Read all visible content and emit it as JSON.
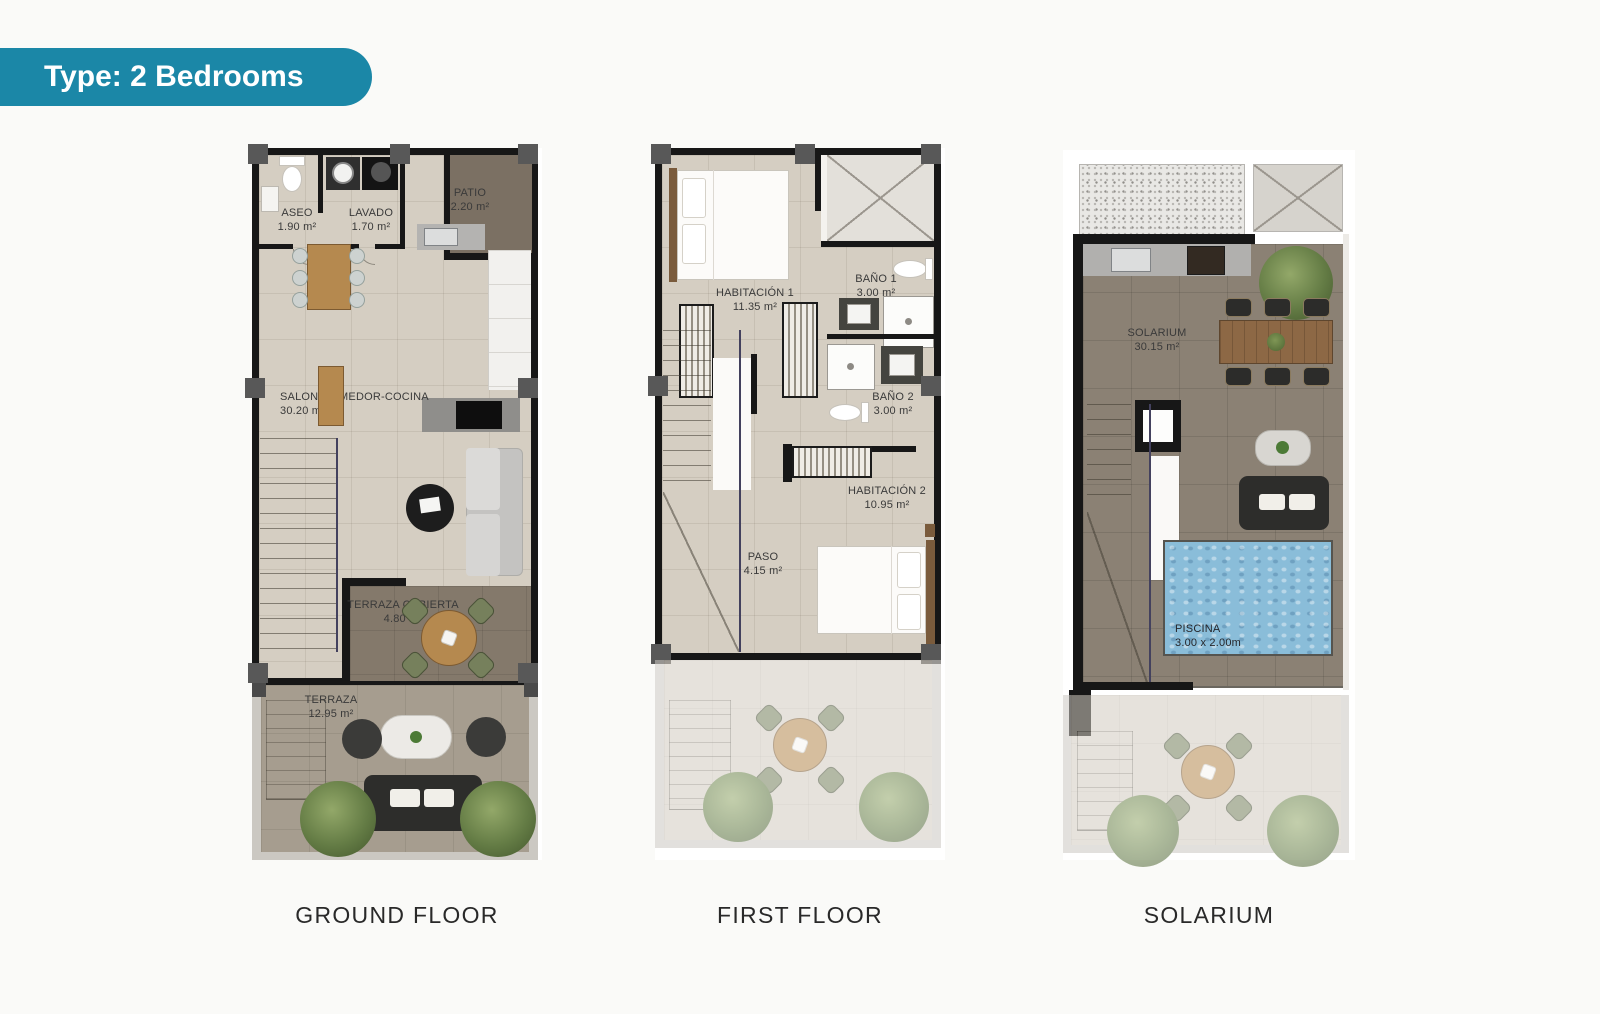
{
  "badge": {
    "label": "Type: 2 Bedrooms"
  },
  "floors": [
    {
      "caption": "GROUND FLOOR",
      "rooms": {
        "aseo": {
          "name": "ASEO",
          "area": "1.90 m²"
        },
        "lavado": {
          "name": "LAVADO",
          "area": "1.70 m²"
        },
        "patio": {
          "name": "PATIO",
          "area": "2.20 m²"
        },
        "salon": {
          "name": "SALON-COMEDOR-COCINA",
          "area": "30.20 m²"
        },
        "terraza_cubierta": {
          "name": "TERRAZA CUBIERTA",
          "area": "4.80 m²"
        },
        "terraza": {
          "name": "TERRAZA",
          "area": "12.95 m²"
        }
      }
    },
    {
      "caption": "FIRST FLOOR",
      "rooms": {
        "habitacion1": {
          "name": "HABITACIÓN 1",
          "area": "11.35 m²"
        },
        "bano1": {
          "name": "BAÑO 1",
          "area": "3.00 m²"
        },
        "bano2": {
          "name": "BAÑO 2",
          "area": "3.00 m²"
        },
        "habitacion2": {
          "name": "HABITACIÓN 2",
          "area": "10.95 m²"
        },
        "paso": {
          "name": "PASO",
          "area": "4.15 m²"
        }
      }
    },
    {
      "caption": "SOLARIUM",
      "rooms": {
        "solarium": {
          "name": "SOLARIUM",
          "area": "30.15 m²"
        },
        "piscina": {
          "name": "PISCINA",
          "area": "3.00 x 2.00m"
        }
      }
    }
  ],
  "colors": {
    "badge_bg": "#1b87a7",
    "wall_black": "#171717",
    "floor_beige": "#d5cec2",
    "terrace_covered_brown": "#84796b",
    "patio_brown": "#7b7063",
    "terrace_gray": "#a69d8f",
    "pool_blue": "#8abdd9",
    "pillar_gray": "#585858"
  }
}
